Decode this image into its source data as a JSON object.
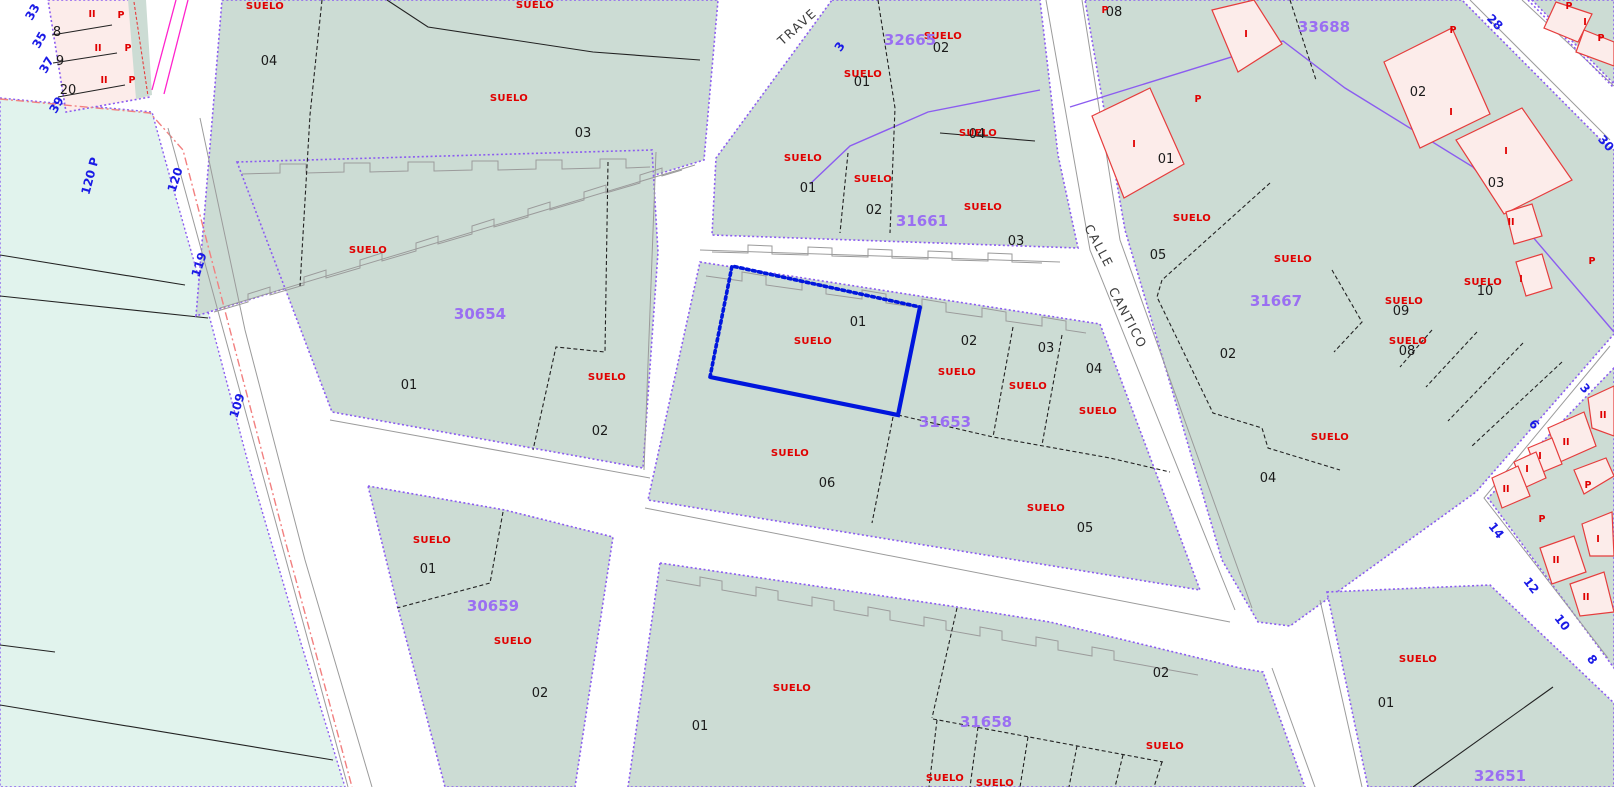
{
  "colors": {
    "parcel_fill": "#ccdcd4",
    "rural_fill": "#e1f3ed",
    "boundary_purple": "#8b5cf0",
    "block_label_purple": "#9a6ff2",
    "suelo_red": "#e00000",
    "building_fill": "#fcecea",
    "building_stroke": "#e63c3c",
    "selection_blue": "#0016dd",
    "house_number_blue": "#1a1ae6",
    "parcel_number_black": "#1a1a1a",
    "road_white": "#ffffff",
    "reference_line_red": "#f28080",
    "boundary_magenta": "#ff22cc"
  },
  "texts": {
    "suelo": "SUELO"
  },
  "streets": {
    "calle": "CALLE",
    "cantico": "CANTICO",
    "travesia_partial": "TRAVE"
  },
  "block_labels": {
    "b30654": "30654",
    "b30659": "30659",
    "b31653": "31653",
    "b31658": "31658",
    "b31661": "31661",
    "b31667": "31667",
    "b32651": "32651",
    "b32665": "32665",
    "b33688": "33688"
  },
  "parcel_numbers": {
    "n01": "01",
    "n02": "02",
    "n03": "03",
    "n04": "04",
    "n05": "05",
    "n06": "06",
    "n08": "08",
    "n09": "09",
    "n10": "10",
    "n8": "8",
    "n9": "9",
    "n20": "20"
  },
  "house_numbers": {
    "h3": "3",
    "h6": "6",
    "h8": "8",
    "h10": "10",
    "h12": "12",
    "h14": "14",
    "h28": "28",
    "h30": "30",
    "h33": "33",
    "h35": "35",
    "h37": "37",
    "h39": "39",
    "h109": "109",
    "h119": "119",
    "h120": "120",
    "h120p": "120 P"
  },
  "building_codes": {
    "one": "I",
    "two": "II",
    "p": "P"
  },
  "selection": {
    "parcel_number": "01",
    "block": "31653"
  }
}
